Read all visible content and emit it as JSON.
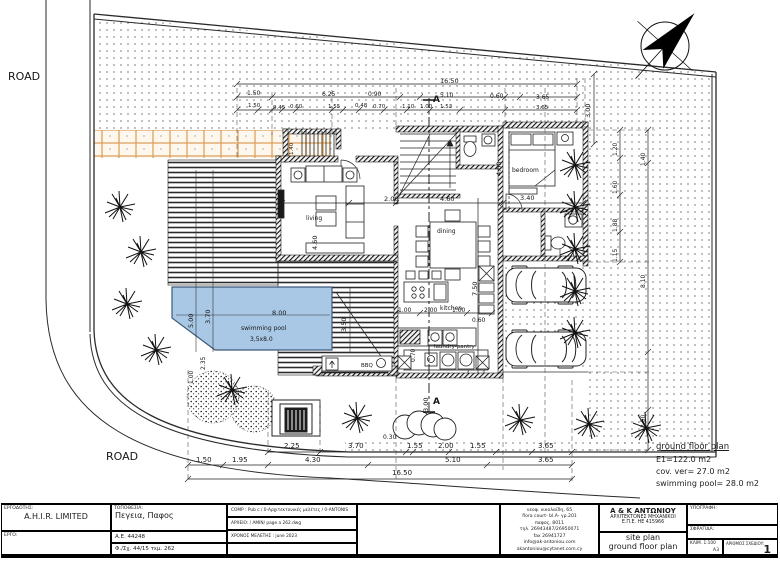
{
  "colors": {
    "ink": "#1c1c1c",
    "wall": "#141414",
    "pool": "#a9c8e6",
    "poolline": "#3d5a77",
    "paveline": "#dc9c55",
    "pavebg": "#fdf7ee",
    "dot": "#3c3c3c"
  },
  "roads": {
    "left": "ROAD",
    "bottom": "ROAD"
  },
  "notes": {
    "title": "ground floor plan",
    "line1": "E1=122.0 m2",
    "line2": "cov. ver= 27.0 m2",
    "line3": "swimming pool=  28.0 m2"
  },
  "titleblock": {
    "owner_label": "ΕΡΓΟΔΟΤΗΣ:",
    "owner": "A.H.I.R. LIMITED",
    "project_label": "ΕΡΓΟ:",
    "location_label": "ΤΟΠΟΘΕΣΙΑ:",
    "location": "Πεγεια, Παφος",
    "reg1": "Α.Ε. 44248",
    "reg2": "Φ./Σχ. 44/15  τεμ. 262",
    "comp": "COMP : Pub c / 0-Αρχιτεκτονικές μελέτες / 0-ANTONIS",
    "file": "ΑΡΧΕΙΟ: / AMIN/ page a 262.dwg",
    "studytime": "ΧΡΟΝΟΣ ΜΕΛΕΤΗΣ : june 2023",
    "firm": {
      "address_lines": [
        "νεοφ. νικολαϊδη, 65",
        "flora court- bl.A- γρ.201",
        "παφος, 8011",
        "τηλ. 26943487/26950071",
        "fax 26941727",
        "info@ak-antoniou.com",
        "akantoniou@cytanet.com.cy"
      ],
      "name1": "Α & Κ ΑΝΤΩΝΙΟΥ",
      "name2": "ΑΡΧΙΤΕΚΤΟΝΕΣ ΜΗΧΑΝΙΚΟΙ",
      "name3": "Ε.Π.Ε.   ΗΕ 415966",
      "drawing1": "site plan",
      "drawing2": "ground floor plan"
    },
    "signature_label": "ΥΠΟΓΡΑΦΗ:",
    "stamp_label": "ΣΦΡΑΓΙΔΑ:",
    "scale": "ΚΛΙΜ. 1:100",
    "paper": "Α3",
    "number_label": "ΑΡΙΘΜΟΣ ΣΧΕΔΙΟΥ:",
    "number": "1"
  },
  "annotations": [
    {
      "t": "ROAD",
      "x": 8,
      "y": 71,
      "s": 11,
      "n": "road-label-left"
    },
    {
      "t": "ROAD",
      "x": 106,
      "y": 451,
      "s": 11,
      "n": "road-label-bottom"
    },
    {
      "t": "A",
      "x": 433,
      "y": 96,
      "s": 9,
      "b": 1,
      "n": "section-marker-a-top"
    },
    {
      "t": "A",
      "x": 433,
      "y": 398,
      "s": 9,
      "b": 1,
      "n": "section-marker-a-bottom"
    },
    {
      "t": "living",
      "x": 306,
      "y": 216,
      "s": 6,
      "n": "room-label-living"
    },
    {
      "t": "bedroom",
      "x": 512,
      "y": 168,
      "s": 6,
      "n": "room-label-bedroom"
    },
    {
      "t": "dining",
      "x": 437,
      "y": 229,
      "s": 6,
      "n": "room-label-dining"
    },
    {
      "t": "kitchen",
      "x": 440,
      "y": 306,
      "s": 6,
      "n": "room-label-kitchen"
    },
    {
      "t": "laundry-pantry",
      "x": 434,
      "y": 345,
      "s": 5.5,
      "n": "room-label-laundry"
    },
    {
      "t": "BBQ",
      "x": 361,
      "y": 364,
      "s": 5.5,
      "n": "room-label-bbq"
    },
    {
      "t": "swimming pool",
      "x": 241,
      "y": 326,
      "s": 6,
      "n": "pool-label"
    },
    {
      "t": "3,5x8.0",
      "x": 250,
      "y": 337,
      "s": 6,
      "n": "pool-size-label"
    },
    {
      "t": "2.25",
      "x": 284,
      "y": 443,
      "s": 7
    },
    {
      "t": "3.70",
      "x": 348,
      "y": 443,
      "s": 7
    },
    {
      "t": "0.30",
      "x": 383,
      "y": 435,
      "s": 6
    },
    {
      "t": "1.55",
      "x": 407,
      "y": 443,
      "s": 7
    },
    {
      "t": "2.00",
      "x": 438,
      "y": 443,
      "s": 7
    },
    {
      "t": "1.55",
      "x": 470,
      "y": 443,
      "s": 7
    },
    {
      "t": "3.65",
      "x": 538,
      "y": 443,
      "s": 7
    },
    {
      "t": "1.50",
      "x": 196,
      "y": 457,
      "s": 7
    },
    {
      "t": "1.95",
      "x": 232,
      "y": 457,
      "s": 7
    },
    {
      "t": "4.30",
      "x": 305,
      "y": 457,
      "s": 7
    },
    {
      "t": "5.10",
      "x": 445,
      "y": 457,
      "s": 7
    },
    {
      "t": "3.65",
      "x": 538,
      "y": 457,
      "s": 7
    },
    {
      "t": "16.50",
      "x": 392,
      "y": 470,
      "s": 7
    },
    {
      "t": "16.50",
      "x": 440,
      "y": 78,
      "s": 6.5
    },
    {
      "t": "1.50",
      "x": 247,
      "y": 91,
      "s": 6
    },
    {
      "t": "6.25",
      "x": 322,
      "y": 92,
      "s": 6
    },
    {
      "t": "0.90",
      "x": 368,
      "y": 92,
      "s": 6
    },
    {
      "t": "5.10",
      "x": 440,
      "y": 93,
      "s": 6
    },
    {
      "t": "0.60",
      "x": 490,
      "y": 94,
      "s": 6
    },
    {
      "t": "3.65",
      "x": 536,
      "y": 95,
      "s": 6
    },
    {
      "t": "1.50",
      "x": 248,
      "y": 104,
      "s": 5.5
    },
    {
      "t": "0.45",
      "x": 273,
      "y": 106,
      "s": 5.5
    },
    {
      "t": "0.60",
      "x": 290,
      "y": 105,
      "s": 5.5
    },
    {
      "t": "1.55",
      "x": 328,
      "y": 105,
      "s": 5.5
    },
    {
      "t": "0.48",
      "x": 355,
      "y": 104,
      "s": 5.5
    },
    {
      "t": "0.70",
      "x": 373,
      "y": 105,
      "s": 5.5
    },
    {
      "t": "1.10",
      "x": 402,
      "y": 105,
      "s": 5.5
    },
    {
      "t": "1.00",
      "x": 420,
      "y": 105,
      "s": 5.5
    },
    {
      "t": "1.53",
      "x": 440,
      "y": 105,
      "s": 5.5
    },
    {
      "t": "3.65",
      "x": 536,
      "y": 106,
      "s": 5.5
    },
    {
      "t": "3.00",
      "x": 585,
      "y": 118,
      "r": -90,
      "s": 6.5
    },
    {
      "t": "1.20",
      "x": 613,
      "y": 156,
      "r": -90,
      "s": 6
    },
    {
      "t": "1.60",
      "x": 613,
      "y": 194,
      "r": -90,
      "s": 6
    },
    {
      "t": "1.88",
      "x": 613,
      "y": 232,
      "r": -90,
      "s": 6
    },
    {
      "t": "1.15",
      "x": 613,
      "y": 262,
      "r": -90,
      "s": 6
    },
    {
      "t": "1.40",
      "x": 641,
      "y": 166,
      "r": -90,
      "s": 6
    },
    {
      "t": "8.10",
      "x": 641,
      "y": 288,
      "r": -90,
      "s": 6
    },
    {
      "t": "2.50",
      "x": 641,
      "y": 428,
      "r": -90,
      "s": 6
    },
    {
      "t": "2.00",
      "x": 384,
      "y": 196,
      "s": 6.5
    },
    {
      "t": "4.60",
      "x": 440,
      "y": 196,
      "s": 6.5
    },
    {
      "t": "3.40",
      "x": 520,
      "y": 195,
      "s": 6.5
    },
    {
      "t": "4.00",
      "x": 496,
      "y": 176,
      "r": -90,
      "s": 6.5
    },
    {
      "t": "7.50",
      "x": 472,
      "y": 296,
      "r": -90,
      "s": 6.5
    },
    {
      "t": "4.60",
      "x": 312,
      "y": 250,
      "r": -90,
      "s": 6.5
    },
    {
      "t": "1.40",
      "x": 290,
      "y": 155,
      "r": -90,
      "s": 5.5
    },
    {
      "t": "1.00",
      "x": 398,
      "y": 308,
      "s": 6
    },
    {
      "t": "2.00",
      "x": 424,
      "y": 308,
      "s": 6
    },
    {
      "t": "1.00",
      "x": 452,
      "y": 308,
      "s": 6
    },
    {
      "t": "0.60",
      "x": 472,
      "y": 318,
      "s": 6
    },
    {
      "t": "0.70",
      "x": 411,
      "y": 362,
      "r": -90,
      "s": 6
    },
    {
      "t": "3.00",
      "x": 423,
      "y": 412,
      "r": -90,
      "s": 6.5
    },
    {
      "t": "8.00",
      "x": 272,
      "y": 310,
      "s": 6.5
    },
    {
      "t": "5.00",
      "x": 188,
      "y": 328,
      "r": -90,
      "s": 6.5
    },
    {
      "t": "3.70",
      "x": 205,
      "y": 324,
      "r": -90,
      "s": 6.5
    },
    {
      "t": "3.50",
      "x": 341,
      "y": 332,
      "r": -90,
      "s": 6.5
    },
    {
      "t": "2.35",
      "x": 201,
      "y": 370,
      "r": -90,
      "s": 6
    },
    {
      "t": "1.00",
      "x": 189,
      "y": 384,
      "r": -90,
      "s": 6
    }
  ]
}
